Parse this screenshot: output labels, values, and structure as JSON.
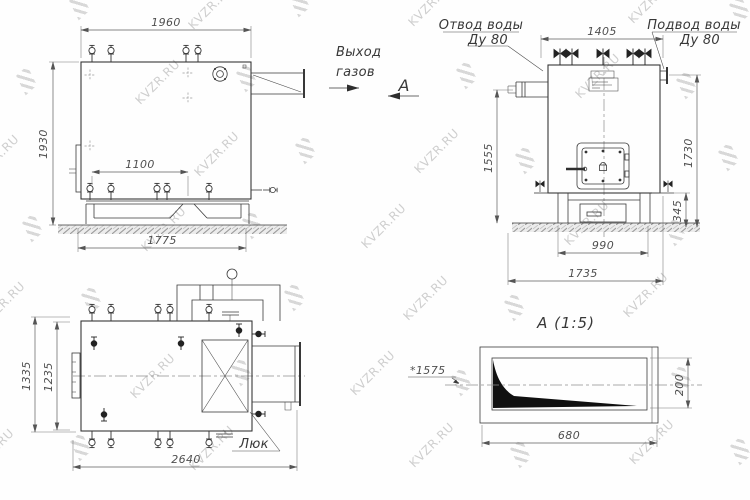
{
  "watermark": {
    "text": "KVZR.RU"
  },
  "annotations": {
    "gas_exit_line1": "Выход",
    "gas_exit_line2": "газов",
    "section_arrow_label": "А"
  },
  "side_view": {
    "dim_width_top": "1960",
    "dim_height_left": "1930",
    "dim_bottom_inner": "1100",
    "dim_base": "1775"
  },
  "front_view": {
    "outlet_label_line1": "Отвод воды",
    "outlet_label_line2": "Ду 80",
    "inlet_label_line1": "Подвод воды",
    "inlet_label_line2": "Ду 80",
    "dim_width_top": "1405",
    "dim_height_left": "1555",
    "dim_height_right": "1730",
    "dim_base_height": "345",
    "dim_base_width": "990",
    "dim_base_total": "1735"
  },
  "plan_view": {
    "dim_height_outer": "1335",
    "dim_height_inner": "1235",
    "dim_width": "2640",
    "hatch_label": "Люк"
  },
  "section_view": {
    "title": "А  (1:5)",
    "scale_note": "*1575",
    "dim_width": "680",
    "dim_height": "200"
  }
}
